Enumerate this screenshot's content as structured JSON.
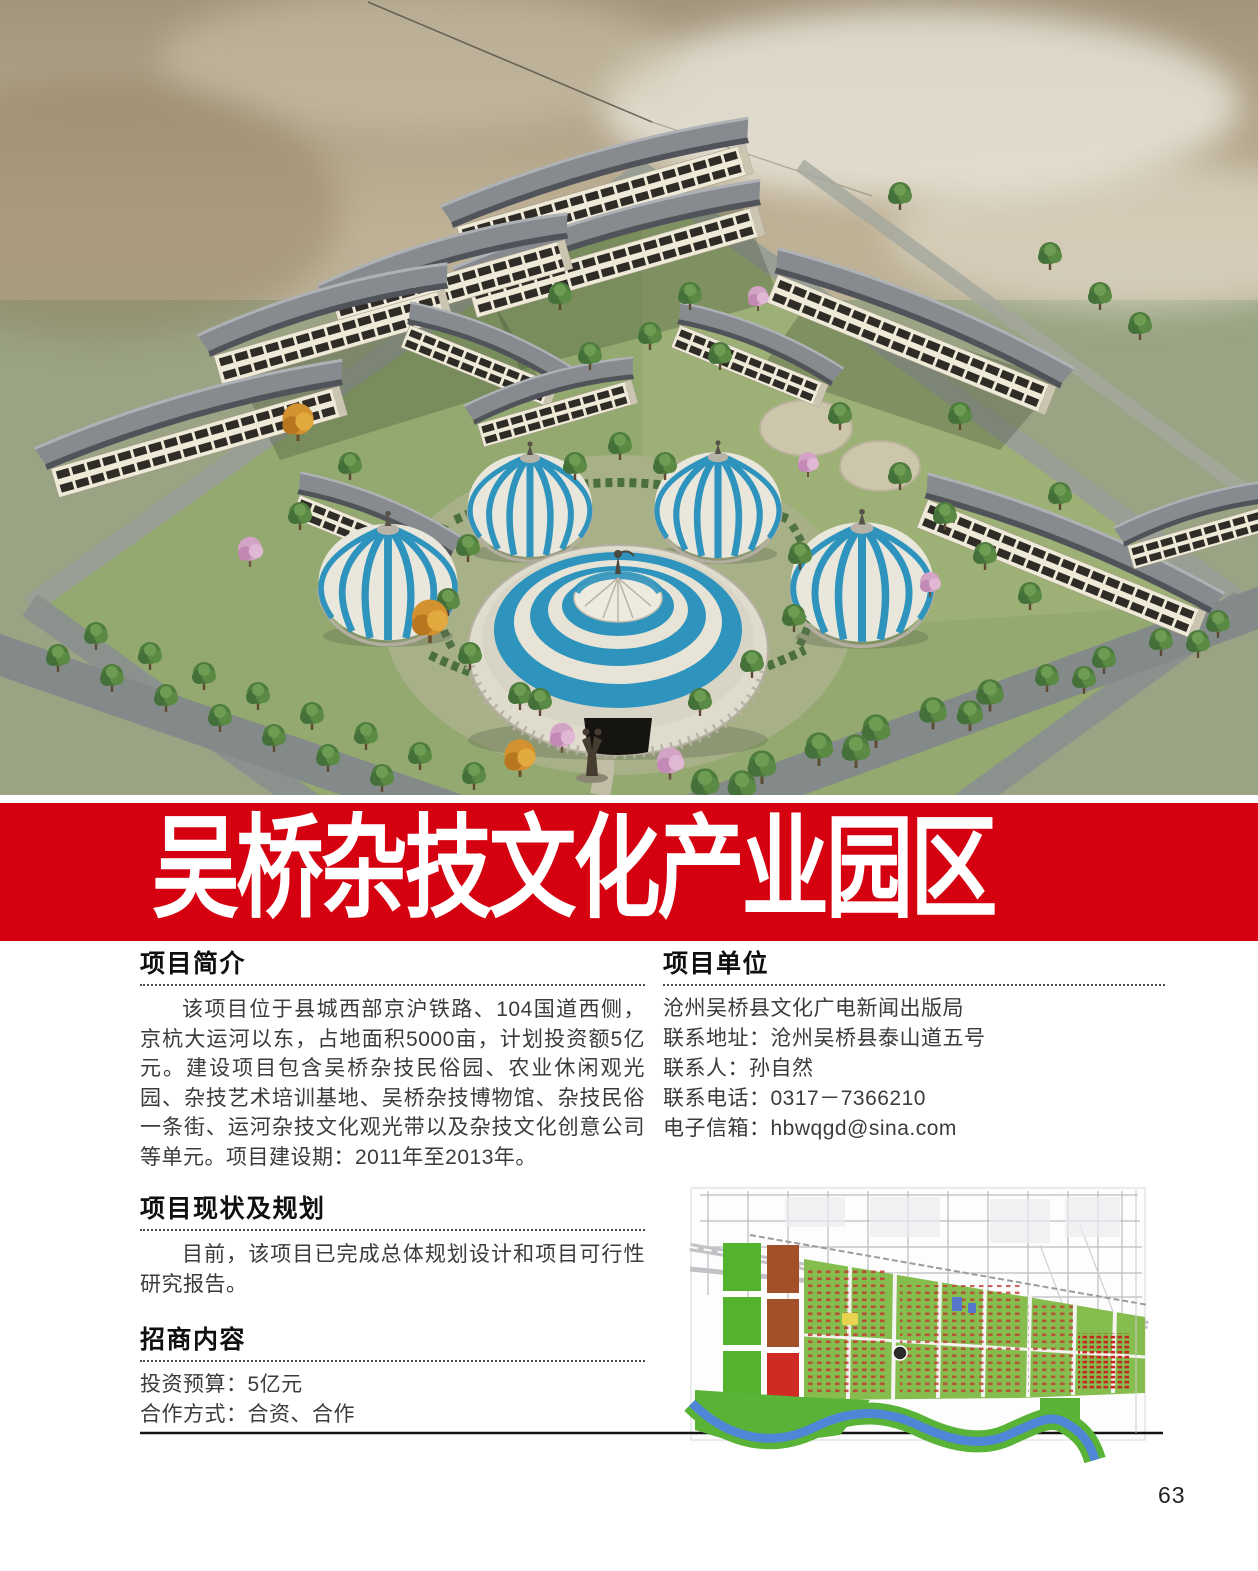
{
  "page": {
    "number": "63",
    "background": "#ffffff"
  },
  "banner": {
    "title": "吴桥杂技文化产业园区",
    "background_color": "#d60110",
    "text_color": "#ffffff"
  },
  "hero": {
    "colors": {
      "sky_haze": "#bfb195",
      "lawn_green": "#93a96f",
      "roof_gray": "#878b8f",
      "wall_cream": "#efe9d8",
      "dome_blue": "#2e93bd",
      "dome_white": "#e9e6db"
    }
  },
  "sections": {
    "intro": {
      "heading": "项目简介",
      "body": "该项目位于县城西部京沪铁路、104国道西侧，京杭大运河以东，占地面积5000亩，计划投资额5亿元。建设项目包含吴桥杂技民俗园、农业休闲观光园、杂技艺术培训基地、吴桥杂技博物馆、杂技民俗一条街、运河杂技文化观光带以及杂技文化创意公司等单元。项目建设期：2011年至2013年。"
    },
    "status": {
      "heading": "项目现状及规划",
      "body": "目前，该项目已完成总体规划设计和项目可行性研究报告。"
    },
    "investment": {
      "heading": "招商内容",
      "lines": [
        "投资预算：5亿元",
        "合作方式：合资、合作"
      ]
    },
    "unit": {
      "heading": "项目单位",
      "lines": [
        "沧州吴桥县文化广电新闻出版局",
        "联系地址：沧州吴桥县泰山道五号",
        "联系人：孙自然",
        "联系电话：0317－7366210",
        "电子信箱：hbwqgd@sina.com"
      ]
    }
  },
  "map": {
    "colors": {
      "green_parcel": "#55b22e",
      "brown_parcel": "#a3502a",
      "red_parcel": "#cf2b24",
      "river_blue": "#4f86d6",
      "planned_green": "#86bd4f"
    }
  }
}
